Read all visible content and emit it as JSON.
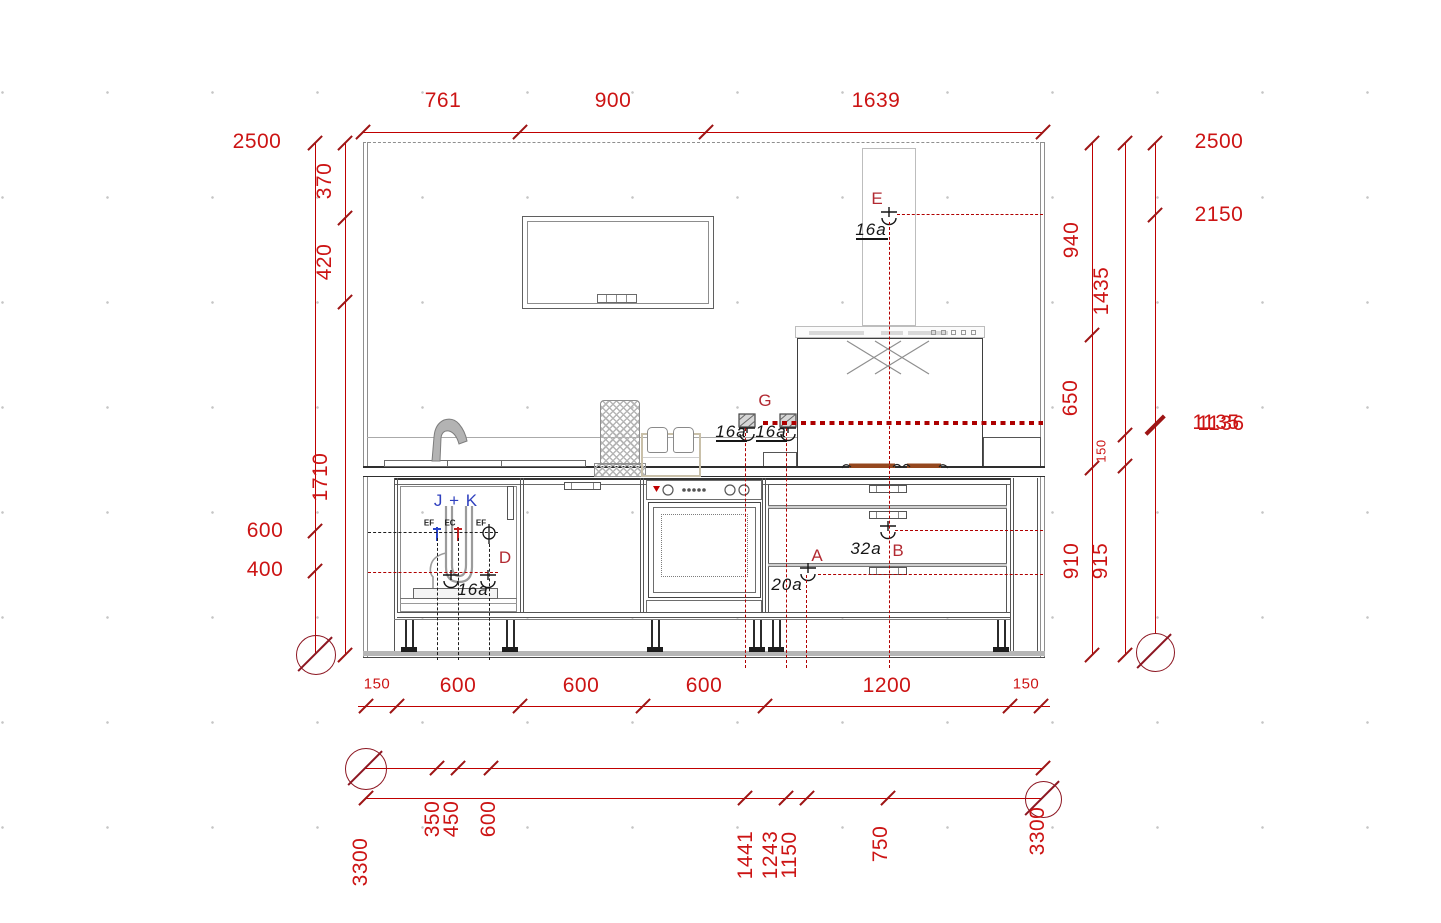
{
  "drawing": {
    "type": "kitchen elevation CAD drawing",
    "units": "mm"
  },
  "colors": {
    "dimension_line": "#c00000",
    "dimension_text": "#cc1414",
    "datum_symbol": "#8d1722",
    "annotation_red": "#b22a32",
    "annotation_black": "#161616",
    "annotation_blue": "#2e3fbe",
    "hob": "#95481f"
  },
  "dim_labels": {
    "top": {
      "d761": "761",
      "d900": "900",
      "d1639": "1639"
    },
    "left": {
      "d2500": "2500",
      "d370": "370",
      "d420": "420",
      "d1710": "1710",
      "d600": "600",
      "d400": "400"
    },
    "right": {
      "d2500": "2500",
      "d2150": "2150",
      "d1135": "1135",
      "d1136": "1136",
      "d940": "940",
      "d1435": "1435",
      "d650": "650",
      "d150": "150",
      "d910": "910",
      "d915": "915"
    },
    "bottom": {
      "d150a": "150",
      "d600a": "600",
      "d600b": "600",
      "d600c": "600",
      "d1200": "1200",
      "d150b": "150"
    },
    "baseline": {
      "d3300L": "3300",
      "d350": "350",
      "d450": "450",
      "d600": "600",
      "d1441": "1441",
      "d1243": "1243",
      "d1150": "1150",
      "d750": "750",
      "d3300R": "3300"
    }
  },
  "annotations": {
    "socket_e": "E",
    "socket_g": "G",
    "socket_a": "A",
    "socket_b": "B",
    "socket_d": "D",
    "amp_e": "16a",
    "amp_g1": "16a",
    "amp_g2": "16a",
    "amp_a": "20a",
    "amp_b": "32a",
    "amp_d": "16a",
    "appliance_group": "J + K",
    "tiny1": "EF",
    "tiny2": "EC",
    "tiny3": "EF"
  }
}
